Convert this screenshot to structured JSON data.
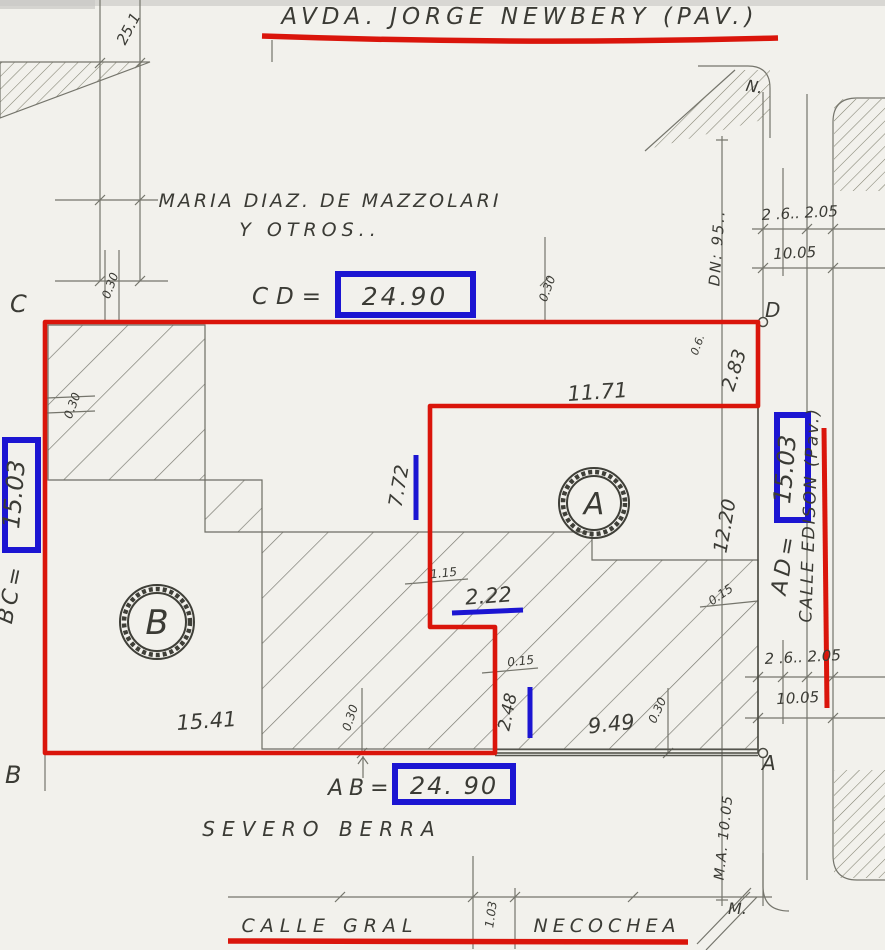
{
  "streets": {
    "top": "AVDA.   JORGE NEWBERY   (PAV.)",
    "right": "CALLE EDISON (Pav.)",
    "bottom_a": "CALLE   GRAL",
    "bottom_b": "NECOCHEA",
    "neighbor_south": "SEVERO BERRA",
    "neighbor_north_1": "MARIA DIAZ. DE MAZZOLARI",
    "neighbor_north_2": "Y   OTROS.."
  },
  "corners": {
    "c": "C",
    "d": "D",
    "b": "B",
    "a": "A",
    "block_ne": "N.",
    "block_se": "M."
  },
  "parcels": {
    "a": "A",
    "b": "B"
  },
  "frontages": {
    "cd_label": "CD=",
    "cd_value": "24.90",
    "ab_label": "AB=",
    "ab_value": "24. 90",
    "bc_label": "BC=",
    "bc_value": "15.03",
    "ad_label": "AD=",
    "ad_value": "15.03"
  },
  "measures": {
    "m25": "25.1",
    "m1171": "11.71",
    "m283": "2.83",
    "m06": "0.6.",
    "m1220": "12.20",
    "m772": "7.72",
    "m222": "2.22",
    "m115": "1.15",
    "m015": "0.15",
    "m248": "2.48",
    "m949": "9.49",
    "m1541": "15.41",
    "m030": "0.30",
    "m103": "1.03",
    "m2605": "2 .6.. 2.05",
    "m1005": "10.05",
    "dn": "DN: 95..",
    "ma": "M.A. 10.05"
  },
  "colors": {
    "annotation_red": "#da150b",
    "annotation_blue": "#1c15d2",
    "pencil": "#75756c",
    "ink": "#3b3b35",
    "paper": "#f2f1ec"
  }
}
